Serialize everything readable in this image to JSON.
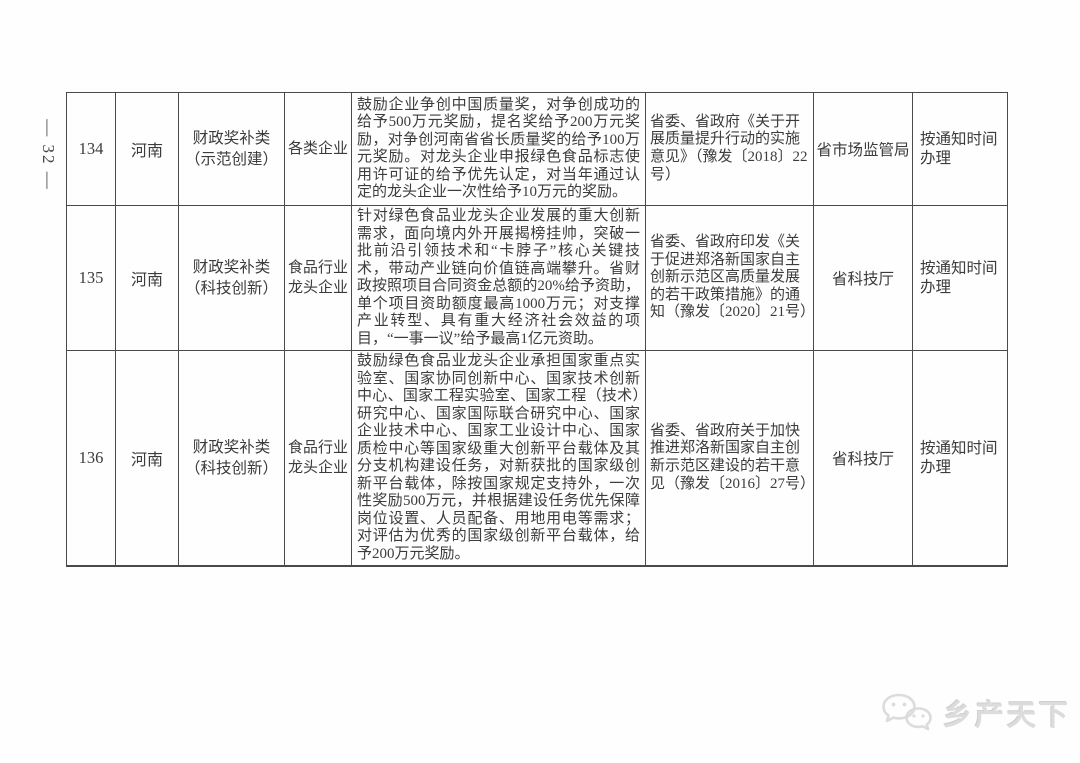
{
  "page": {
    "page_number": "— 32 —",
    "watermark": {
      "icon": "wechat-logo-icon",
      "text": "乡产天下"
    }
  },
  "colors": {
    "table_border": "#4a4a4a",
    "text": "#3c3c3c",
    "watermark": "#dcdcdc",
    "background": "#fefefe"
  },
  "table": {
    "rows": [
      {
        "id": "134",
        "province": "河南",
        "category": "财政奖补类",
        "category_sub": "（示范创建）",
        "target": "各类企业",
        "content": "鼓励企业争创中国质量奖，对争创成功的给予500万元奖励，提名奖给予200万元奖励，对争创河南省省长质量奖的给予100万元奖励。对龙头企业申报绿色食品标志使用许可证的给予优先认定，对当年通过认定的龙头企业一次性给予10万元的奖励。",
        "basis": "省委、省政府《关于开展质量提升行动的实施意见》（豫发〔2018〕22号）",
        "department": "省市场监管局",
        "schedule": "按通知时间办理"
      },
      {
        "id": "135",
        "province": "河南",
        "category": "财政奖补类",
        "category_sub": "（科技创新）",
        "target": "食品行业龙头企业",
        "content": "针对绿色食品业龙头企业发展的重大创新需求，面向境内外开展揭榜挂帅，突破一批前沿引领技术和“卡脖子”核心关键技术，带动产业链向价值链高端攀升。省财政按照项目合同资金总额的20%给予资助，单个项目资助额度最高1000万元；对支撑产业转型、具有重大经济社会效益的项目，“一事一议”给予最高1亿元资助。",
        "basis": "省委、省政府印发《关于促进郑洛新国家自主创新示范区高质量发展的若干政策措施》的通知（豫发〔2020〕21号）",
        "department": "省科技厅",
        "schedule": "按通知时间办理"
      },
      {
        "id": "136",
        "province": "河南",
        "category": "财政奖补类",
        "category_sub": "（科技创新）",
        "target": "食品行业龙头企业",
        "content": "鼓励绿色食品业龙头企业承担国家重点实验室、国家协同创新中心、国家技术创新中心、国家工程实验室、国家工程（技术）研究中心、国家国际联合研究中心、国家企业技术中心、国家工业设计中心、国家质检中心等国家级重大创新平台载体及其分支机构建设任务，对新获批的国家级创新平台载体，除按国家规定支持外，一次性奖励500万元，并根据建设任务优先保障岗位设置、人员配备、用地用电等需求；对评估为优秀的国家级创新平台载体，给予200万元奖励。",
        "basis": "省委、省政府关于加快推进郑洛新国家自主创新示范区建设的若干意见（豫发〔2016〕27号）",
        "department": "省科技厅",
        "schedule": "按通知时间办理"
      }
    ]
  }
}
